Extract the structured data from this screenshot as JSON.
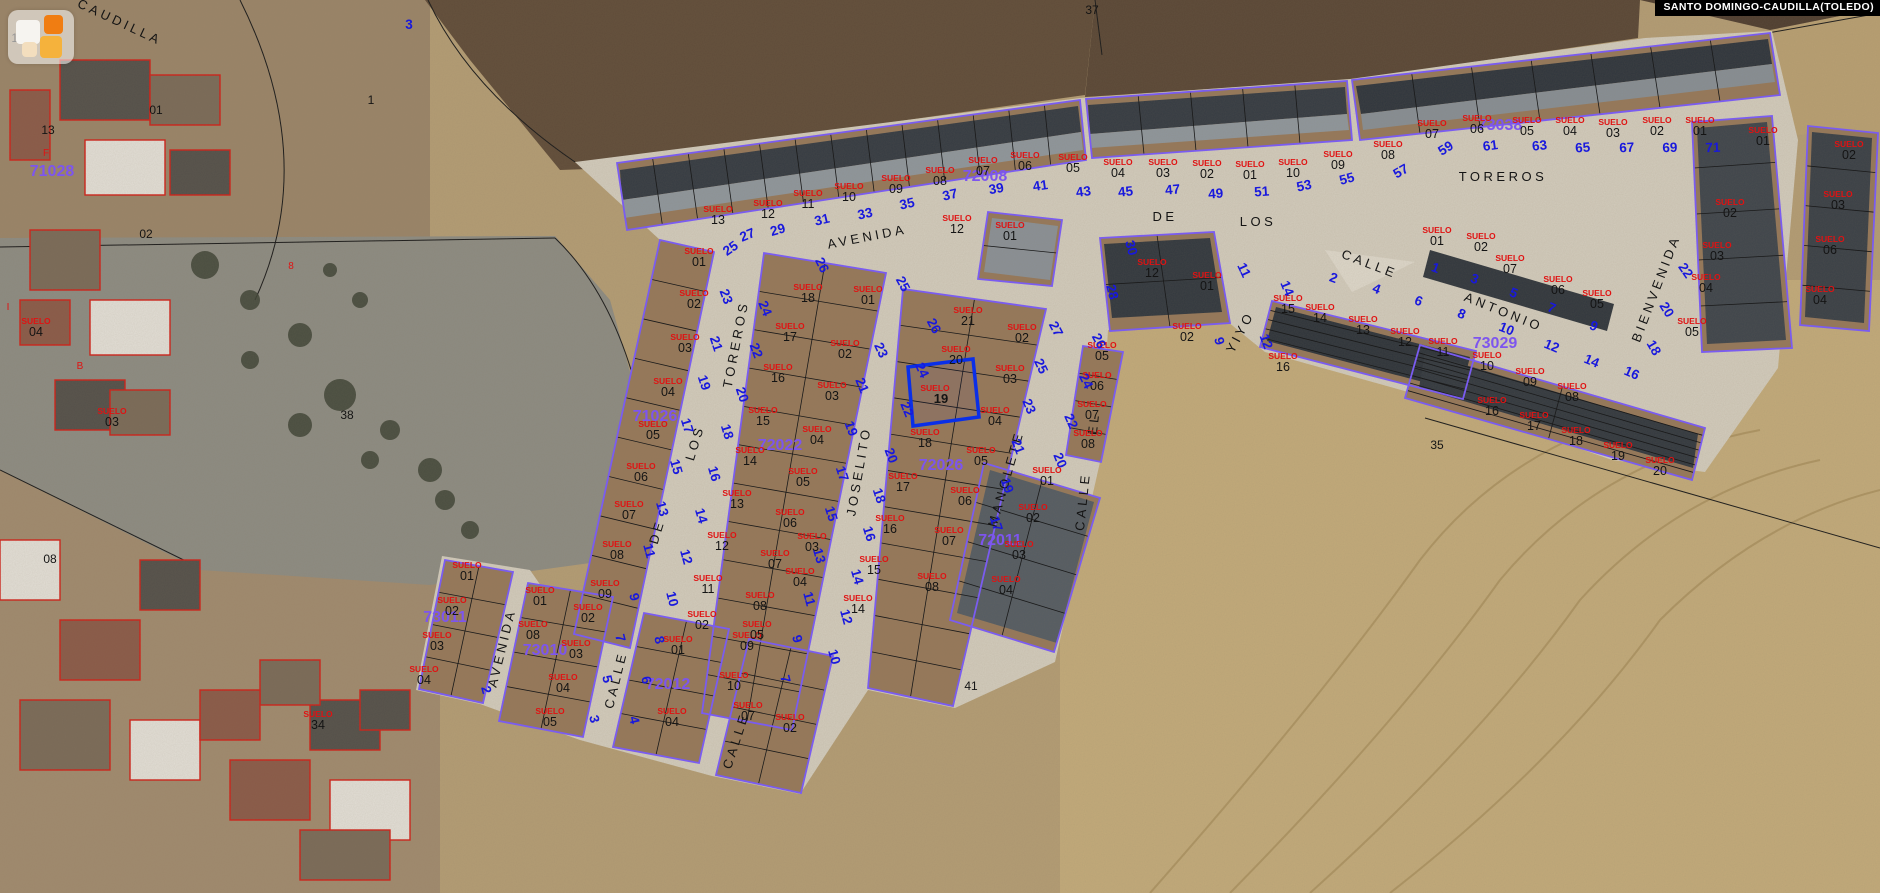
{
  "header": {
    "municipality_label": "SANTO DOMINGO-CAUDILLA(TOLEDO)"
  },
  "logo": {
    "name": "map-widget"
  },
  "map": {
    "colors": {
      "house_number": "#1818dd",
      "suelo": "#e01212",
      "parcel_number": "#141414",
      "block_number": "#7d55ee",
      "street_name": "#141414",
      "selected": "#0a2fe8",
      "boundary": "#7a5cf0",
      "parcel_line": "#1a1a1a",
      "red_outline": "#d02018",
      "header_bg": "#000000",
      "header_fg": "#ffffff"
    },
    "selected_parcel": {
      "suelo": "SUELO",
      "number": "19",
      "outline": [
        [
          908,
          367
        ],
        [
          973,
          359
        ],
        [
          979,
          417
        ],
        [
          913,
          426
        ]
      ],
      "label_x": 941,
      "label_y": 401
    },
    "street_labels": [
      [
        "CAUDILLA",
        118,
        26,
        25
      ],
      [
        "AVENIDA",
        868,
        241,
        -11
      ],
      [
        "DE",
        1165,
        221,
        0
      ],
      [
        "LOS",
        1258,
        226,
        0
      ],
      [
        "TOREROS",
        1503,
        181,
        0
      ],
      [
        "TOREROS",
        740,
        345,
        -79
      ],
      [
        "LOS",
        699,
        444,
        -73
      ],
      [
        "DE",
        661,
        533,
        -73
      ],
      [
        "AVENIDA",
        506,
        649,
        -76
      ],
      [
        "CALLE",
        620,
        681,
        -76
      ],
      [
        "CALLE",
        740,
        742,
        -72
      ],
      [
        "JOSELITO",
        863,
        472,
        -80
      ],
      [
        "MANOLETE",
        1010,
        480,
        -74
      ],
      [
        "EL",
        1098,
        424,
        -84
      ],
      [
        "CALLE",
        1087,
        502,
        -84
      ],
      [
        "YIYO",
        1244,
        334,
        -62
      ],
      [
        "CALLE",
        1368,
        268,
        21
      ],
      [
        "ANTONIO",
        1502,
        316,
        22
      ],
      [
        "BIENVENIDA",
        1660,
        290,
        -69
      ]
    ],
    "block_labels": [
      [
        "71026",
        655,
        421
      ],
      [
        "72008",
        985,
        181
      ],
      [
        "72022",
        780,
        450
      ],
      [
        "72026",
        941,
        470
      ],
      [
        "72011",
        1000,
        545
      ],
      [
        "73038",
        1500,
        130
      ],
      [
        "73029",
        1495,
        348
      ],
      [
        "73011",
        445,
        622
      ],
      [
        "73010",
        545,
        655
      ],
      [
        "72012",
        668,
        689
      ],
      [
        "71028",
        52,
        176
      ]
    ],
    "parcel_labels": [
      [
        "13",
        718,
        222
      ],
      [
        "12",
        768,
        216
      ],
      [
        "11",
        808,
        206
      ],
      [
        "10",
        849,
        199
      ],
      [
        "09",
        896,
        191
      ],
      [
        "08",
        940,
        183
      ],
      [
        "07",
        983,
        173
      ],
      [
        "06",
        1025,
        168
      ],
      [
        "05",
        1073,
        170
      ],
      [
        "04",
        1118,
        175
      ],
      [
        "03",
        1163,
        175
      ],
      [
        "02",
        1207,
        176
      ],
      [
        "01",
        1250,
        177
      ],
      [
        "10",
        1293,
        175
      ],
      [
        "09",
        1338,
        167
      ],
      [
        "08",
        1388,
        157
      ],
      [
        "07",
        1432,
        136
      ],
      [
        "06",
        1477,
        131
      ],
      [
        "05",
        1527,
        133
      ],
      [
        "04",
        1570,
        133
      ],
      [
        "03",
        1613,
        135
      ],
      [
        "02",
        1657,
        133
      ],
      [
        "01",
        1700,
        133
      ],
      [
        "01",
        1763,
        143
      ],
      [
        "02",
        1730,
        215
      ],
      [
        "03",
        1717,
        258
      ],
      [
        "04",
        1706,
        290
      ],
      [
        "05",
        1692,
        334
      ],
      [
        "02",
        1849,
        157
      ],
      [
        "03",
        1838,
        207
      ],
      [
        "06",
        1830,
        252
      ],
      [
        "04",
        1820,
        302
      ],
      [
        "01",
        699,
        264
      ],
      [
        "02",
        694,
        306
      ],
      [
        "03",
        685,
        350
      ],
      [
        "04",
        668,
        394
      ],
      [
        "05",
        653,
        437
      ],
      [
        "06",
        641,
        479
      ],
      [
        "07",
        629,
        517
      ],
      [
        "08",
        617,
        557
      ],
      [
        "09",
        605,
        596
      ],
      [
        "18",
        808,
        300
      ],
      [
        "17",
        790,
        339
      ],
      [
        "16",
        778,
        380
      ],
      [
        "15",
        763,
        423
      ],
      [
        "14",
        750,
        463
      ],
      [
        "13",
        737,
        506
      ],
      [
        "12",
        722,
        548
      ],
      [
        "11",
        708,
        591
      ],
      [
        "01",
        868,
        302
      ],
      [
        "02",
        845,
        356
      ],
      [
        "03",
        832,
        398
      ],
      [
        "04",
        817,
        442
      ],
      [
        "05",
        803,
        484
      ],
      [
        "06",
        790,
        525
      ],
      [
        "07",
        775,
        566
      ],
      [
        "08",
        760,
        608
      ],
      [
        "09",
        747,
        648
      ],
      [
        "10",
        734,
        688
      ],
      [
        "21",
        968,
        323
      ],
      [
        "20",
        956,
        362
      ],
      [
        "18",
        925,
        445
      ],
      [
        "17",
        903,
        489
      ],
      [
        "16",
        890,
        531
      ],
      [
        "15",
        874,
        572
      ],
      [
        "14",
        858,
        611
      ],
      [
        "02",
        1022,
        340
      ],
      [
        "03",
        1010,
        381
      ],
      [
        "04",
        995,
        423
      ],
      [
        "05",
        981,
        463
      ],
      [
        "06",
        965,
        503
      ],
      [
        "07",
        949,
        543
      ],
      [
        "08",
        932,
        589
      ],
      [
        "01",
        1047,
        483
      ],
      [
        "02",
        1033,
        520
      ],
      [
        "03",
        1019,
        557
      ],
      [
        "04",
        1006,
        592
      ],
      [
        "05",
        1102,
        358
      ],
      [
        "06",
        1097,
        388
      ],
      [
        "07",
        1092,
        417
      ],
      [
        "08",
        1088,
        446
      ],
      [
        "12",
        1152,
        275
      ],
      [
        "01",
        1207,
        288
      ],
      [
        "02",
        1187,
        339
      ],
      [
        "12",
        957,
        231
      ],
      [
        "01",
        1010,
        238
      ],
      [
        "15",
        1288,
        311
      ],
      [
        "14",
        1320,
        320
      ],
      [
        "13",
        1363,
        332
      ],
      [
        "12",
        1405,
        344
      ],
      [
        "16",
        1283,
        369
      ],
      [
        "01",
        1437,
        243
      ],
      [
        "02",
        1481,
        249
      ],
      [
        "07",
        1510,
        271
      ],
      [
        "06",
        1558,
        292
      ],
      [
        "05",
        1597,
        306
      ],
      [
        "11",
        1443,
        354
      ],
      [
        "10",
        1487,
        368
      ],
      [
        "09",
        1530,
        384
      ],
      [
        "08",
        1572,
        399
      ],
      [
        "16",
        1492,
        413
      ],
      [
        "17",
        1534,
        428
      ],
      [
        "18",
        1576,
        443
      ],
      [
        "19",
        1618,
        458
      ],
      [
        "20",
        1660,
        473
      ],
      [
        "01",
        467,
        578
      ],
      [
        "02",
        452,
        613
      ],
      [
        "03",
        437,
        648
      ],
      [
        "04",
        424,
        682
      ],
      [
        "01",
        540,
        603
      ],
      [
        "02",
        588,
        620
      ],
      [
        "08",
        533,
        637
      ],
      [
        "03",
        576,
        656
      ],
      [
        "04",
        563,
        690
      ],
      [
        "05",
        550,
        724
      ],
      [
        "01",
        678,
        652
      ],
      [
        "02",
        702,
        627
      ],
      [
        "05",
        757,
        637
      ],
      [
        "04",
        800,
        584
      ],
      [
        "03",
        812,
        549
      ],
      [
        "07",
        748,
        718
      ],
      [
        "04",
        672,
        724
      ],
      [
        "02",
        790,
        730
      ],
      [
        "03",
        112,
        424
      ],
      [
        "04",
        36,
        334
      ],
      [
        "34",
        318,
        727
      ]
    ],
    "plain_labels": [
      [
        "13",
        48,
        134,
        "k",
        12
      ],
      [
        "01",
        156,
        114,
        "k",
        12
      ],
      [
        "02",
        146,
        238,
        "k",
        12
      ],
      [
        "08",
        50,
        563,
        "k",
        12
      ],
      [
        "18",
        18,
        42,
        "k",
        12
      ],
      [
        "38",
        347,
        419,
        "k",
        12
      ],
      [
        "1",
        371,
        104,
        "k",
        12
      ],
      [
        "35",
        1437,
        449,
        "k",
        12
      ],
      [
        "41",
        971,
        690,
        "k",
        12
      ],
      [
        "37",
        1092,
        14,
        "k",
        12
      ],
      [
        "8",
        291,
        269,
        "r",
        10
      ],
      [
        "I",
        8,
        310,
        "r",
        10
      ],
      [
        "B",
        80,
        369,
        "r",
        10
      ],
      [
        "F",
        46,
        156,
        "r",
        10
      ]
    ],
    "house_numbers": [
      [
        "25",
        733,
        252,
        -35
      ],
      [
        "27",
        749,
        239,
        -22
      ],
      [
        "29",
        779,
        234,
        -16
      ],
      [
        "31",
        823,
        224,
        -13
      ],
      [
        "33",
        866,
        218,
        -12
      ],
      [
        "35",
        908,
        208,
        -12
      ],
      [
        "37",
        951,
        199,
        -13
      ],
      [
        "39",
        997,
        193,
        -10
      ],
      [
        "41",
        1041,
        190,
        -8
      ],
      [
        "43",
        1084,
        196,
        -7
      ],
      [
        "45",
        1126,
        196,
        -6
      ],
      [
        "47",
        1173,
        194,
        -5
      ],
      [
        "49",
        1216,
        198,
        -4
      ],
      [
        "51",
        1262,
        196,
        -4
      ],
      [
        "53",
        1305,
        190,
        -12
      ],
      [
        "55",
        1348,
        183,
        -15
      ],
      [
        "57",
        1403,
        175,
        -30
      ],
      [
        "59",
        1448,
        152,
        -32
      ],
      [
        "61",
        1491,
        150,
        -8
      ],
      [
        "63",
        1540,
        150,
        -6
      ],
      [
        "65",
        1583,
        152,
        -4
      ],
      [
        "67",
        1627,
        152,
        -3
      ],
      [
        "69",
        1670,
        152,
        -2
      ],
      [
        "71",
        1713,
        152,
        -2
      ],
      [
        "23",
        722,
        298,
        70
      ],
      [
        "21",
        712,
        345,
        72
      ],
      [
        "19",
        700,
        384,
        72
      ],
      [
        "17",
        683,
        427,
        73
      ],
      [
        "15",
        672,
        468,
        74
      ],
      [
        "13",
        658,
        510,
        74
      ],
      [
        "11",
        645,
        552,
        75
      ],
      [
        "9",
        630,
        598,
        76
      ],
      [
        "7",
        616,
        639,
        76
      ],
      [
        "5",
        603,
        680,
        77
      ],
      [
        "3",
        590,
        720,
        77
      ],
      [
        "26",
        818,
        267,
        64
      ],
      [
        "24",
        761,
        310,
        68
      ],
      [
        "22",
        752,
        352,
        70
      ],
      [
        "20",
        738,
        396,
        72
      ],
      [
        "18",
        723,
        433,
        73
      ],
      [
        "16",
        710,
        475,
        74
      ],
      [
        "14",
        697,
        517,
        74
      ],
      [
        "12",
        682,
        558,
        75
      ],
      [
        "10",
        668,
        600,
        76
      ],
      [
        "8",
        655,
        641,
        76
      ],
      [
        "6",
        642,
        681,
        77
      ],
      [
        "4",
        630,
        721,
        77
      ],
      [
        "25",
        899,
        286,
        62
      ],
      [
        "23",
        877,
        352,
        65
      ],
      [
        "21",
        858,
        387,
        68
      ],
      [
        "19",
        847,
        430,
        70
      ],
      [
        "17",
        838,
        475,
        72
      ],
      [
        "15",
        827,
        515,
        73
      ],
      [
        "13",
        815,
        557,
        74
      ],
      [
        "11",
        805,
        600,
        75
      ],
      [
        "9",
        793,
        640,
        75
      ],
      [
        "7",
        781,
        680,
        76
      ],
      [
        "26",
        930,
        328,
        62
      ],
      [
        "24",
        918,
        372,
        65
      ],
      [
        "22",
        903,
        411,
        68
      ],
      [
        "20",
        887,
        457,
        70
      ],
      [
        "18",
        875,
        497,
        72
      ],
      [
        "16",
        865,
        535,
        73
      ],
      [
        "14",
        853,
        578,
        74
      ],
      [
        "12",
        842,
        618,
        75
      ],
      [
        "10",
        830,
        658,
        75
      ],
      [
        "27",
        1052,
        331,
        62
      ],
      [
        "25",
        1037,
        368,
        65
      ],
      [
        "23",
        1025,
        408,
        67
      ],
      [
        "21",
        1014,
        448,
        69
      ],
      [
        "19",
        1003,
        487,
        71
      ],
      [
        "17",
        992,
        525,
        72
      ],
      [
        "26",
        1095,
        343,
        62
      ],
      [
        "24",
        1082,
        383,
        64
      ],
      [
        "22",
        1067,
        423,
        66
      ],
      [
        "20",
        1056,
        462,
        68
      ],
      [
        "30",
        1127,
        249,
        75
      ],
      [
        "28",
        1108,
        293,
        76
      ],
      [
        "11",
        1240,
        272,
        65
      ],
      [
        "14",
        1283,
        290,
        68
      ],
      [
        "12",
        1262,
        343,
        70
      ],
      [
        "9",
        1215,
        342,
        77
      ],
      [
        "2",
        1332,
        282,
        20
      ],
      [
        "4",
        1375,
        293,
        21
      ],
      [
        "6",
        1417,
        305,
        22
      ],
      [
        "8",
        1460,
        318,
        22
      ],
      [
        "1",
        1434,
        272,
        20
      ],
      [
        "3",
        1473,
        283,
        21
      ],
      [
        "5",
        1512,
        297,
        22
      ],
      [
        "7",
        1550,
        312,
        23
      ],
      [
        "9",
        1592,
        330,
        24
      ],
      [
        "10",
        1505,
        333,
        22
      ],
      [
        "12",
        1550,
        350,
        23
      ],
      [
        "14",
        1590,
        365,
        23
      ],
      [
        "16",
        1630,
        377,
        24
      ],
      [
        "22",
        1682,
        273,
        55
      ],
      [
        "20",
        1663,
        312,
        58
      ],
      [
        "18",
        1650,
        350,
        60
      ],
      [
        "3",
        409,
        29,
        0
      ],
      [
        "2",
        482,
        691,
        75
      ]
    ]
  }
}
